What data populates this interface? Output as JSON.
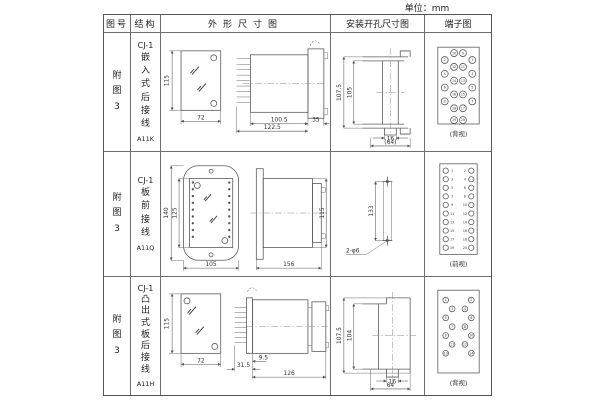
{
  "unit_label": "单位：mm",
  "colors": {
    "line": "#5a5a5a",
    "border": "#555555",
    "text": "#222222"
  },
  "header": {
    "fig": "图号",
    "struct": "结构",
    "outline": "外形尺寸图",
    "mount": "安装开孔尺寸图",
    "terminal": "端子图"
  },
  "rows": [
    {
      "fig": "附\n图\n3",
      "struct_model": "CJ-1",
      "struct_text": "嵌\n入\n式\n后\n接\n线",
      "struct_code": "A11K",
      "outline_dims": {
        "front_height": "115",
        "front_width": "72",
        "body_len": "100.5",
        "flange": "35",
        "total_len": "122.5"
      },
      "mount_dims": {
        "outer": "107.5",
        "inner": "105",
        "tab": "16",
        "width": "(64)"
      },
      "terminal": {
        "outer_left": [
          "2",
          "4",
          "6",
          "8"
        ],
        "inner_left": [
          "10",
          "12",
          "14",
          "16",
          "18"
        ],
        "inner_right": [
          "9",
          "11",
          "13",
          "15",
          "17"
        ],
        "outer_right": [
          "1",
          "3",
          "5",
          "7"
        ],
        "bottom": [
          "19",
          "20"
        ],
        "view": "(背视)"
      }
    },
    {
      "fig": "附\n图\n3",
      "struct_model": "CJ-1",
      "struct_text": "板\n前\n接\n线",
      "struct_code": "A11Q",
      "outline_dims": {
        "outer_height": "140",
        "inner_height": "125",
        "width": "105",
        "length": "156",
        "height": "115"
      },
      "mount_dims": {
        "span": "133",
        "holes": "2-φ6"
      },
      "terminal": {
        "left": [
          "1",
          "3",
          "5",
          "7",
          "9",
          "11",
          "13",
          "15",
          "17",
          "19"
        ],
        "right": [
          "2",
          "4",
          "6",
          "8",
          "10",
          "12",
          "14",
          "16",
          "18",
          "20"
        ],
        "view": "(前视)"
      }
    },
    {
      "fig": "附\n图\n3",
      "struct_model": "CJ-1",
      "struct_text": "凸\n出\n式\n板\n后\n接\n线",
      "struct_code": "A11H",
      "outline_dims": {
        "front_height": "115",
        "front_width": "72",
        "pins": "31.5",
        "plate": "9.5",
        "total": "126"
      },
      "mount_dims": {
        "outer": "107.5",
        "inner": "104",
        "tab": "16",
        "width": "64"
      },
      "terminal": {
        "left": [
          "1",
          "3",
          "5",
          "7",
          "9",
          "11",
          "13"
        ],
        "right": [
          "2",
          "4",
          "6",
          "8",
          "10",
          "12",
          "14"
        ],
        "view": "(背视)"
      }
    }
  ]
}
